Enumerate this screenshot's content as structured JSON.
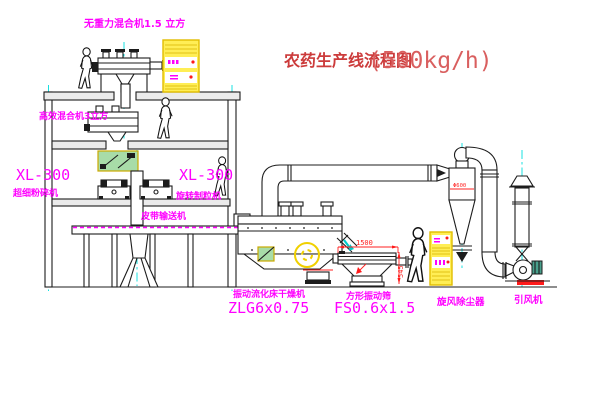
{
  "drawing": {
    "title": {
      "text": "农药生产线流程图",
      "capacity": "(500kg/h)"
    },
    "equipment_labels": {
      "gravity_mixer": "无重力混合机1.5 立方",
      "high_efficiency_mixer": "高效混合机3立方",
      "pulverizer_model": "XL-300",
      "pulverizer_name": "超细粉碎机",
      "granulator_model": "XL-300",
      "granulator_name": "旋转制粒机",
      "belt_conveyor": "皮带输送机",
      "fluid_bed_dryer_name": "振动流化床干燥机",
      "fluid_bed_dryer_model": "ZLG6x0.75",
      "vibrating_screen_name": "方形振动筛",
      "vibrating_screen_model": "FS0.6x1.5",
      "cyclone_dust_collector": "旋风除尘器",
      "induced_draft_fan": "引风机"
    },
    "dimensions": {
      "screen_length": "1500",
      "screen_height": "545",
      "cyclone_diameter": "Φ600"
    },
    "colors": {
      "label_magenta": "#ff00ff",
      "title_red": "#cc3b3b",
      "capacity_red": "#d95f5f",
      "dimension_red": "#ff2222",
      "cabinet_yellow": "#ffee55",
      "centerline_cyan": "#00dddd",
      "line_black": "#1c1c1c",
      "motor_teal": "#49a08c",
      "base_red": "#ff1a1a"
    }
  }
}
